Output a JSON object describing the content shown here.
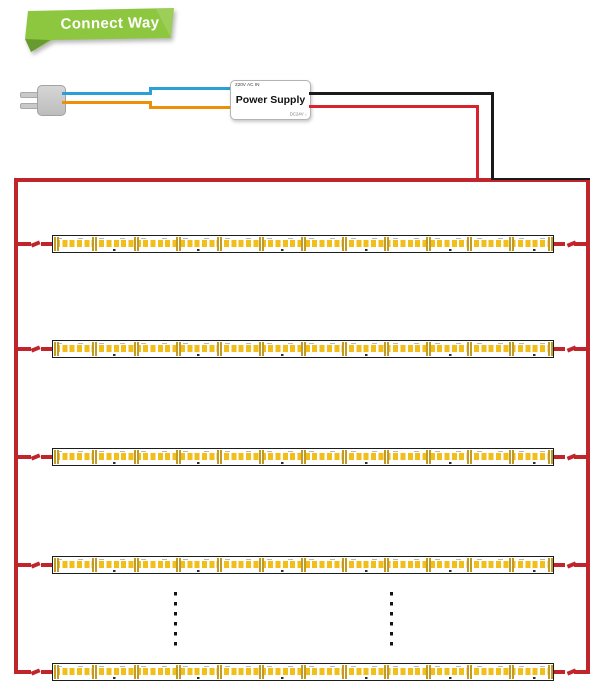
{
  "banner": {
    "label": "Connect Way"
  },
  "power_supply": {
    "input_label": "220V AC IN",
    "title": "Power Supply",
    "output_label": "DC24V ↓"
  },
  "colors": {
    "banner_green": "#8DC63F",
    "banner_fold": "#679B2F",
    "wire_blue": "#2B9FD8",
    "wire_orange": "#EC9006",
    "wire_red": "#D8232E",
    "wire_black": "#1A1A1A",
    "panel_red": "#C0252B",
    "led_yellow": "#F2BE1A",
    "pad_gold": "#C19B25"
  },
  "led_panel": {
    "strip_count": 5,
    "segments_per_strip": 12,
    "rows_y": [
      235,
      340,
      448,
      556,
      663
    ],
    "strip_x": 52,
    "strip_width": 502,
    "strip_height": 18,
    "continuation_dots": {
      "columns_x": [
        174,
        390
      ],
      "top_y": 592,
      "dot_count": 6
    }
  }
}
